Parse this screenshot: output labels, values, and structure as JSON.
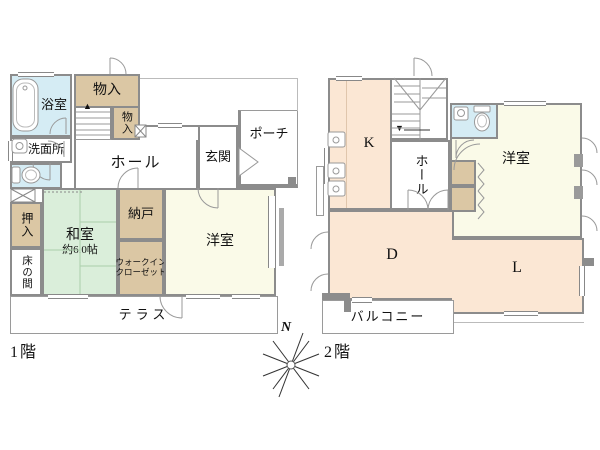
{
  "colors": {
    "wall": "#8c8c8c",
    "tan": "#dbc7a4",
    "blue": "#d5ecf4",
    "green": "#daeeda",
    "cream": "#fafae8",
    "peach": "#fbe7d4",
    "white": "#ffffff"
  },
  "floor1": {
    "label": "1階",
    "stairs_arrow": "▲",
    "rooms": {
      "bath": "浴室",
      "storage_top": "物入",
      "storage_side": "物入",
      "washroom": "洗面所",
      "hall": "ホール",
      "entrance": "玄関",
      "porch": "ポーチ",
      "oshiire": "押入",
      "tokonoma": "床の間",
      "washitsu": "和室",
      "washitsu_size": "約6.0帖",
      "storeroom": "納戸",
      "wic_line1": "ウォークイン",
      "wic_line2": "クローゼット",
      "yoshitsu": "洋室",
      "terrace": "テラス"
    }
  },
  "floor2": {
    "label": "2階",
    "stairs_arrow": "▼",
    "rooms": {
      "kitchen": "K",
      "hall": "ホール",
      "yoshitsu": "洋室",
      "dining": "D",
      "living": "L",
      "balcony": "バルコニー"
    }
  },
  "compass": {
    "north": "N"
  },
  "icons": [
    "bathtub-icon",
    "washbasin-icon",
    "toilet-icon",
    "kitchen-sink-icon",
    "toilet-2f-sink-icon",
    "compass-rose-icon"
  ]
}
